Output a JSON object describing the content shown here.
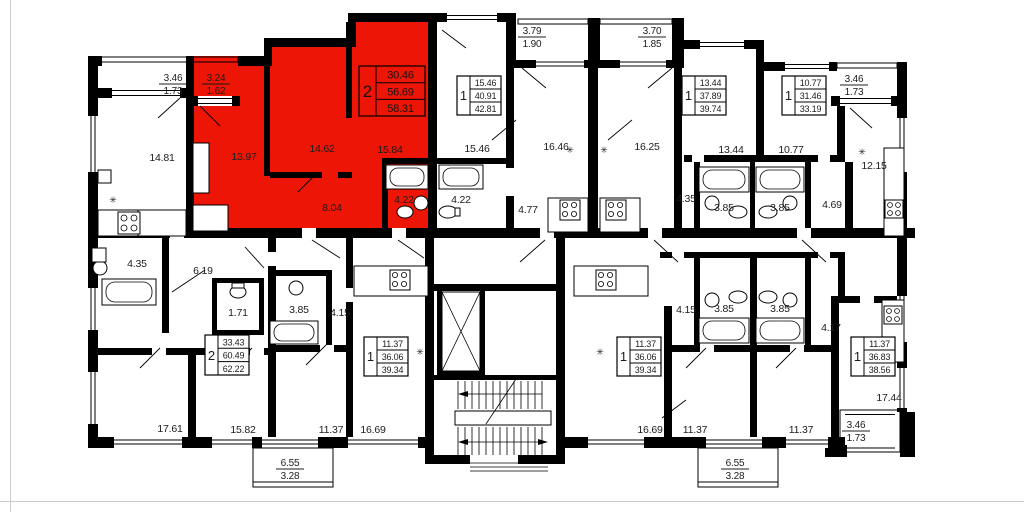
{
  "plan": {
    "background": "#ffffff",
    "wall_color": "#000000",
    "highlight_color": "#ed1505",
    "text_color": "#1c1c1c",
    "type_label": "floor-plan"
  },
  "icons": {
    "vent": "✳"
  },
  "apartments": [
    {
      "id": "highlighted-2-room",
      "rooms": "2",
      "living_area": "30.46",
      "area": "56.69",
      "total_area": "58.31",
      "highlighted": true
    },
    {
      "id": "top-1-room-a",
      "rooms": "1",
      "living_area": "15.46",
      "area": "40.91",
      "total_area": "42.81",
      "highlighted": false
    },
    {
      "id": "top-1-room-b",
      "rooms": "1",
      "living_area": "13.44",
      "area": "37.89",
      "total_area": "39.74",
      "highlighted": false
    },
    {
      "id": "top-right-1-room",
      "rooms": "1",
      "living_area": "10.77",
      "area": "31.46",
      "total_area": "33.19",
      "highlighted": false
    },
    {
      "id": "left-2-room",
      "rooms": "2",
      "living_area": "33.43",
      "area": "60.49",
      "total_area": "62.22",
      "highlighted": false
    },
    {
      "id": "bottom-1-room-left",
      "rooms": "1",
      "living_area": "11.37",
      "area": "36.06",
      "total_area": "39.34",
      "highlighted": false
    },
    {
      "id": "bottom-1-room-right",
      "rooms": "1",
      "living_area": "11.37",
      "area": "36.06",
      "total_area": "39.34",
      "highlighted": false
    },
    {
      "id": "bottom-right-1-room",
      "rooms": "1",
      "living_area": "11.37",
      "area": "36.83",
      "total_area": "38.56",
      "highlighted": false
    }
  ],
  "room_labels": [
    {
      "text": "14.81"
    },
    {
      "text": "13.97"
    },
    {
      "text": "14.62"
    },
    {
      "text": "15.84"
    },
    {
      "text": "8.04"
    },
    {
      "text": "4.22"
    },
    {
      "text": "4.22"
    },
    {
      "text": "15.46"
    },
    {
      "text": "16.46"
    },
    {
      "text": "16.25"
    },
    {
      "text": "4.77"
    },
    {
      "text": "4.35"
    },
    {
      "text": "3.85"
    },
    {
      "text": "3.85"
    },
    {
      "text": "4.69"
    },
    {
      "text": "13.44"
    },
    {
      "text": "10.77"
    },
    {
      "text": "12.15"
    },
    {
      "text": "4.35"
    },
    {
      "text": "6.19"
    },
    {
      "text": "1.71"
    },
    {
      "text": "3.85"
    },
    {
      "text": "4.15"
    },
    {
      "text": "17.61"
    },
    {
      "text": "15.82"
    },
    {
      "text": "11.37"
    },
    {
      "text": "16.69"
    },
    {
      "text": "16.69"
    },
    {
      "text": "11.37"
    },
    {
      "text": "11.37"
    },
    {
      "text": "17.44"
    },
    {
      "text": "4.15"
    },
    {
      "text": "3.85"
    },
    {
      "text": "3.85"
    },
    {
      "text": "4.17"
    }
  ],
  "balcony_labels": [
    {
      "area": "3.46",
      "reduced": "1.73"
    },
    {
      "area": "3.24",
      "reduced": "1.62"
    },
    {
      "area": "3.79",
      "reduced": "1.90"
    },
    {
      "area": "3.70",
      "reduced": "1.85"
    },
    {
      "area": "3.46",
      "reduced": "1.73"
    },
    {
      "area": "6.55",
      "reduced": "3.28"
    },
    {
      "area": "6.55",
      "reduced": "3.28"
    },
    {
      "area": "3.46",
      "reduced": "1.73"
    }
  ]
}
